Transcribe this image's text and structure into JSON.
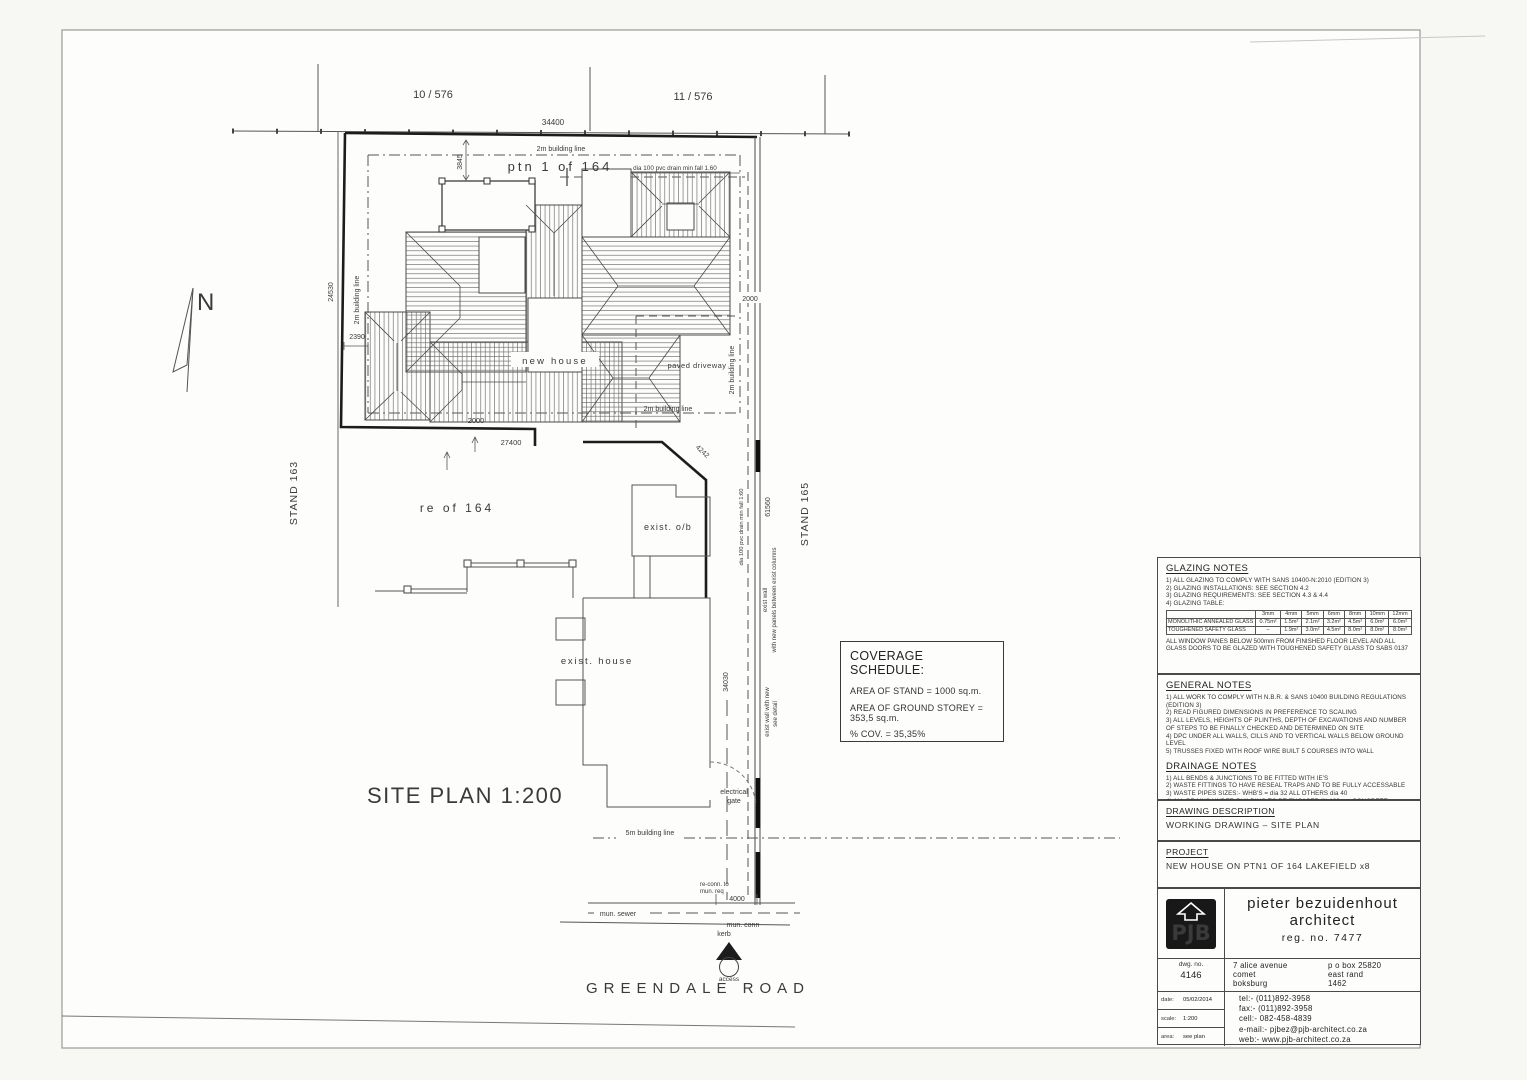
{
  "sheet": {
    "parcels": {
      "p1": "10 / 576",
      "p2": "11 / 576"
    },
    "stands": {
      "left": "STAND 163",
      "right": "STAND 165"
    },
    "north": "N",
    "plan_title": "SITE  PLAN 1:200",
    "road_name": "GREENDALE ROAD",
    "labels": {
      "ptn": "ptn 1 of 164",
      "new_house": "new house",
      "paved_driveway": "paved driveway",
      "re_of": "re of 164",
      "exist_ob": "exist. o/b",
      "exist_house": "exist. house",
      "drain_top": "dia 100 pvc drain min fall 1.60",
      "drain_side": "dia 100 pvc drain min fall 1:60",
      "bl_2m": "2m building line",
      "bl_5m": "5m building line",
      "electrical": "electrical",
      "gate": "gate",
      "exist_wall_1": "exist wall",
      "exist_wall_1b": "with new panels between exist columns",
      "exist_wall_2": "exist wall with new",
      "exist_wall_2b": "see detail",
      "reconn_1": "re-conn. to",
      "reconn_2": "mun. req",
      "mun_sewer": "mun. sewer",
      "mun_conn": "mun. conn",
      "kerb": "kerb",
      "access": "access"
    },
    "dims": {
      "top": "34400",
      "porch": "3845",
      "left": "24530",
      "step": "2390",
      "gate": "2000",
      "bottom": "27400",
      "splay": "4242",
      "right": "2000",
      "side_upper": "61560",
      "side_lower": "34030",
      "mun": "4000"
    }
  },
  "coverage": {
    "title": "COVERAGE SCHEDULE:",
    "area_stand": "AREA OF STAND = 1000 sq.m.",
    "area_storey": "AREA OF GROUND STOREY = 353,5 sq.m.",
    "cov": "% COV. = 35,35%"
  },
  "glazing": {
    "title": "GLAZING NOTES",
    "items": [
      "1)  ALL GLAZING TO COMPLY WITH SANS 10400-N:2010 (EDITION 3)",
      "2)  GLAZING INSTALLATIONS: SEE SECTION 4.2",
      "3)  GLAZING REQUIREMENTS: SEE SECTION 4.3 & 4.4",
      "4)  GLAZING TABLE:"
    ],
    "table": {
      "cols": [
        "3mm",
        "4mm",
        "5mm",
        "6mm",
        "8mm",
        "10mm",
        "12mm"
      ],
      "row1_label": "MONOLITHIC ANNEALED GLASS",
      "row1": [
        "0.75m²",
        "1.5m²",
        "2.1m²",
        "3.2m²",
        "4.5m²",
        "6.0m²",
        "6.0m²"
      ],
      "row2_label": "TOUGHENED SAFETY GLASS",
      "row2": [
        "–",
        "1.9m²",
        "3.0m²",
        "4.5m²",
        "8.0m²",
        "8.0m²",
        "8.0m²"
      ]
    },
    "footnote": "ALL WINDOW PANES BELOW 500mm FROM FINISHED FLOOR LEVEL AND ALL GLASS DOORS TO BE GLAZED WITH TOUGHENED SAFETY GLASS TO SABS 0137"
  },
  "general": {
    "title": "GENERAL NOTES",
    "items": [
      "1)  ALL WORK TO COMPLY WITH N.B.R. & SANS 10400 BUILDING REGULATIONS (EDITION 3)",
      "2)  READ FIGURED DIMENSIONS IN PREFERENCE TO SCALING",
      "3)  ALL LEVELS, HEIGHTS OF PLINTHS, DEPTH OF EXCAVATIONS AND NUMBER OF STEPS TO BE FINALLY CHECKED AND DETERMINED ON SITE",
      "4)  DPC UNDER ALL WALLS, CILLS AND TO VERTICAL WALLS BELOW GROUND LEVEL",
      "5)  TRUSSES FIXED WITH ROOF WIRE BUILT 5 COURSES INTO WALL"
    ]
  },
  "drainage": {
    "title": "DRAINAGE NOTES",
    "items": [
      "1)  ALL BENDS & JUNCTIONS TO BE FITTED WITH IE'S",
      "2)  WASTE FITTINGS TO HAVE RESEAL TRAPS AND TO BE FULLY ACCESSABLE",
      "3)  WASTE PIPES SIZES:- WHB'S = dia 32 ALL OTHERS dia 40",
      "4)  ALL DRAINS UNDER BUILDING TO BE ENCASED IN 100mm CONCRETE"
    ]
  },
  "drawing_description": {
    "title": "DRAWING DESCRIPTION",
    "value": "WORKING DRAWING – SITE PLAN"
  },
  "project": {
    "title": "PROJECT",
    "value": "NEW HOUSE ON PTN1 OF 164 LAKEFIELD x8"
  },
  "titleblock": {
    "logo": "PJB",
    "name_line1": "pieter bezuidenhout",
    "name_line2": "architect",
    "reg": "reg. no. 7477",
    "dwg_label": "dwg. no.",
    "dwg_no": "4146",
    "addr1": "7 alice avenue",
    "addr2": "comet",
    "addr3": "boksburg",
    "po1": "p o box 25820",
    "po2": "east rand",
    "po3": "1462",
    "date_label": "date:",
    "date_value": "05/02/2014",
    "scale_label": "scale:",
    "scale_value": "1:200",
    "area_label": "area:",
    "area_value": "see plan",
    "tel": "tel:-  (011)892-3958",
    "fax": "fax:-  (011)892-3958",
    "cell": "cell:-  082-458-4839",
    "email": "e-mail:-  pjbez@pjb-architect.co.za",
    "web": "web:-  www.pjb-architect.co.za"
  }
}
